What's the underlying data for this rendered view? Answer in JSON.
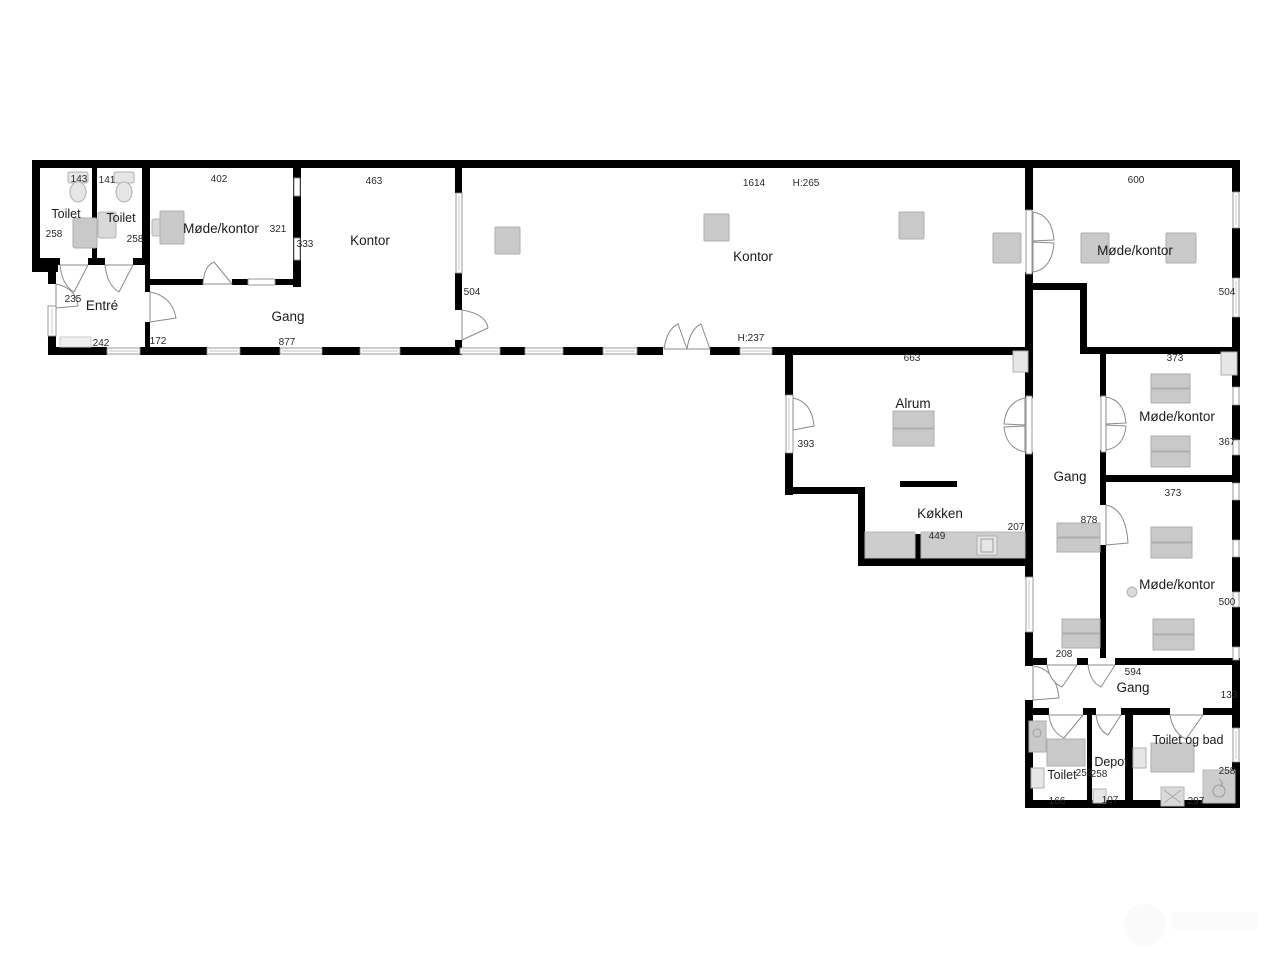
{
  "plan_type": "floor-plan",
  "colors": {
    "wall": "#000000",
    "furniture": "#c9c9c9",
    "window_frame": "#8f8f8f",
    "text": "#1b1b1b"
  },
  "rooms": {
    "toilet_nw_left": {
      "label": "Toilet",
      "dim_width": "143",
      "dim_depth": "258"
    },
    "toilet_nw_right": {
      "label": "Toilet",
      "dim_width": "141",
      "dim_depth": "258"
    },
    "entre": {
      "label": "Entré",
      "dim_depth": "235",
      "dim_width": "242"
    },
    "moede_kontor_nw": {
      "label": "Møde/kontor",
      "dim_width": "402",
      "dim_depth": "321",
      "dim_wall": "333"
    },
    "kontor_west": {
      "label": "Kontor",
      "dim_width": "463",
      "dim_wall": "504"
    },
    "gang_west": {
      "label": "Gang",
      "dim_width": "877",
      "dim_offset": "172"
    },
    "kontor_main": {
      "label": "Kontor",
      "dim_width": "1614",
      "ceiling": "H:265",
      "ceiling_south": "H:237"
    },
    "moede_kontor_ne": {
      "label": "Møde/kontor",
      "dim_width": "600",
      "dim_wall": "504"
    },
    "alrum": {
      "label": "Alrum",
      "dim_width": "663",
      "dim_wall": "393"
    },
    "koekken": {
      "label": "Køkken",
      "dim_width": "449",
      "dim_wall": "207"
    },
    "gang_east": {
      "label": "Gang",
      "dim_length": "878",
      "dim_end": "208"
    },
    "moede_kontor_e1": {
      "label": "Møde/kontor",
      "dim_width": "373",
      "dim_wall": "367"
    },
    "moede_kontor_e2": {
      "label": "Møde/kontor",
      "dim_width": "373",
      "dim_wall": "500"
    },
    "gang_south": {
      "label": "Gang",
      "dim_width": "594",
      "dim_wall": "133"
    },
    "toilet_south": {
      "label": "Toilet",
      "dim_width": "166",
      "dim_depth": "258"
    },
    "depot": {
      "label": "Depot",
      "dim_width": "107",
      "dim_depth": "258"
    },
    "toilet_og_bad": {
      "label": "Toilet og bad",
      "dim_width": "297",
      "dim_depth": "258"
    }
  }
}
